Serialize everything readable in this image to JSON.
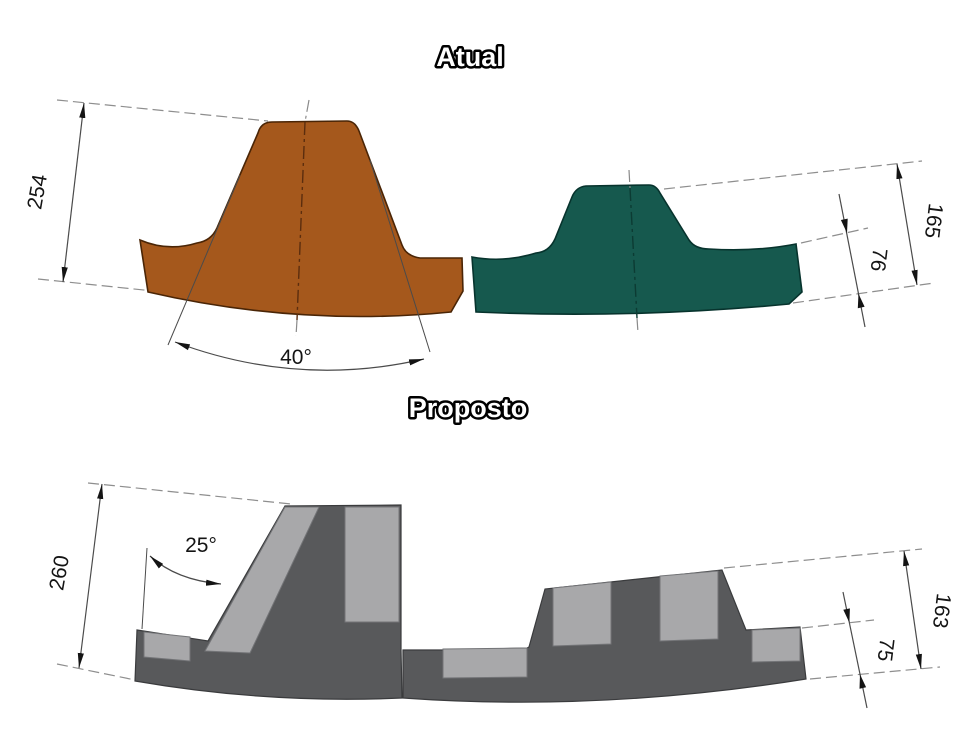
{
  "atual": {
    "title": "Atual",
    "dims": {
      "left_height": "254",
      "lifter_angle": "40°",
      "right_height": "165",
      "right_plate": "76"
    }
  },
  "proposto": {
    "title": "Proposto",
    "dims": {
      "left_height": "260",
      "lifter_angle": "25°",
      "right_height": "163",
      "right_plate": "75"
    }
  },
  "colors": {
    "background": "#ffffff",
    "atual_left_liner": "#a5581c",
    "atual_right_liner": "#16594e",
    "proposto_body": "#58595b",
    "proposto_insert": "#a8a8aa",
    "dimension_text": "#141414"
  }
}
